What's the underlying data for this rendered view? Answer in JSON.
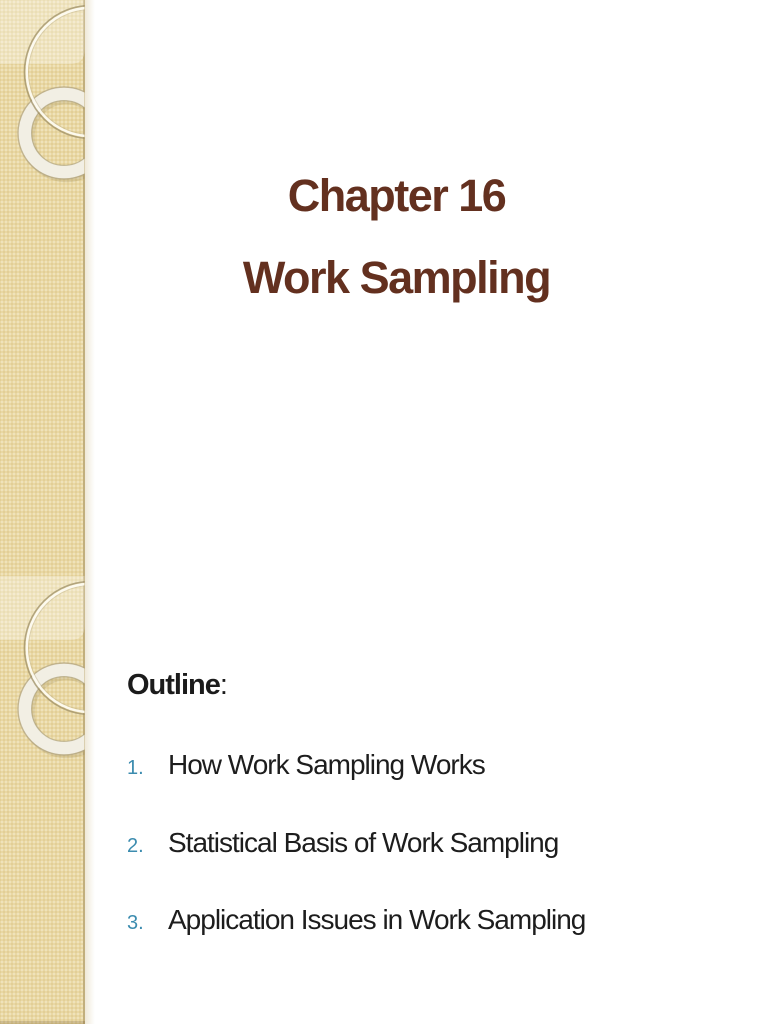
{
  "theme": {
    "sidebar_color": "#e9d8a3",
    "sidebar_border_color": "#c2af7d",
    "title_color": "#63301f",
    "body_text_color": "#1d1d1d",
    "list_number_color": "#3c8caf",
    "background_color": "#ffffff"
  },
  "slide1": {
    "title_line1": "Chapter 16",
    "title_line2": "Work Sampling"
  },
  "slide2": {
    "heading": "Outline",
    "heading_suffix": ":",
    "items": [
      {
        "number": "1.",
        "text": "How Work Sampling Works"
      },
      {
        "number": "2.",
        "text": "Statistical Basis of Work Sampling"
      },
      {
        "number": "3.",
        "text": "Application Issues in Work Sampling"
      }
    ]
  }
}
